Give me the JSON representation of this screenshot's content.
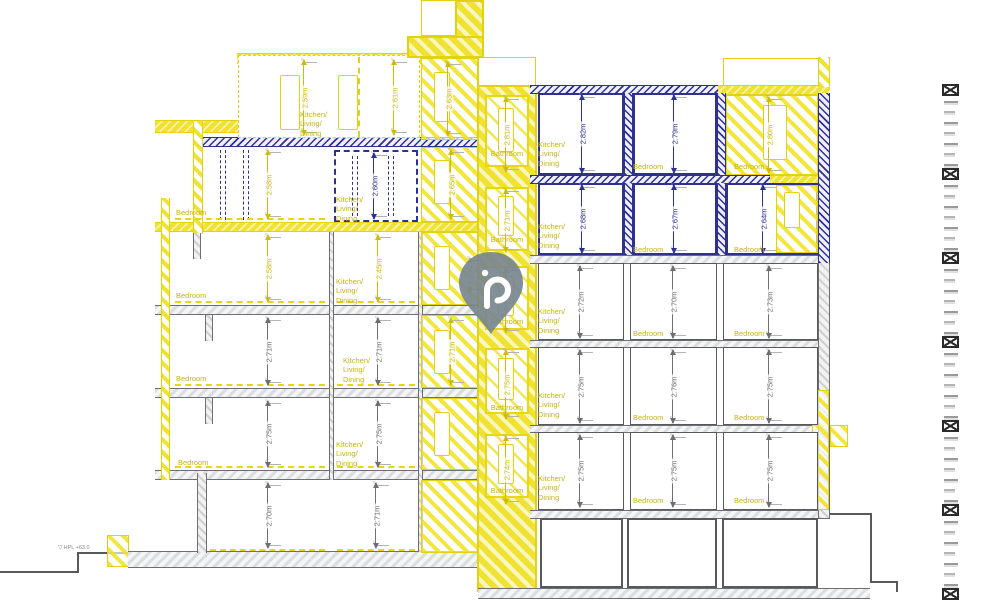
{
  "drawing": {
    "type": "building-section-elevation"
  },
  "colors": {
    "accent_yellow": "#f2e431",
    "label_yellow": "#c6b40f",
    "navy": "#2e3192",
    "wall_gray": "#58595b",
    "pin_gray": "#76848f"
  },
  "left_wing": {
    "floors": [
      {
        "level": "attic",
        "rooms": [
          {
            "label": "Kitchen/\nLiving/\nDining",
            "dim": "2.59m"
          },
          {
            "dim": "2.61m"
          },
          {
            "dim": "2.63m"
          }
        ]
      },
      {
        "level": "4",
        "rooms": [
          {
            "label": "Bedroom",
            "dim": "2.58m"
          },
          {
            "label": "Kitchen/\nLiving/\nDining",
            "dim": "2.60m"
          },
          {
            "dim": "2.65m"
          }
        ]
      },
      {
        "level": "3",
        "rooms": [
          {
            "label": "Bedroom",
            "dim": "2.58m"
          },
          {
            "label": "Kitchen/\nLiving/\nDining",
            "dim": "2.45m"
          }
        ]
      },
      {
        "level": "2",
        "rooms": [
          {
            "label": "Bedroom",
            "dim": "2.71m"
          },
          {
            "label": "Kitchen/\nLiving/\nDining",
            "dim": "2.71m"
          },
          {
            "dim": "2.71m"
          }
        ]
      },
      {
        "level": "1",
        "rooms": [
          {
            "label": "Bedroom",
            "dim": "2.75m"
          },
          {
            "label": "Kitchen/\nLiving/\nDining",
            "dim": "2.75m"
          }
        ]
      },
      {
        "level": "ground",
        "rooms": [
          {
            "dim": "2.70m"
          },
          {
            "dim": "2.71m"
          }
        ]
      }
    ]
  },
  "core": {
    "bathrooms": [
      {
        "label": "Bathroom",
        "dim": "2.81m"
      },
      {
        "label": "Bathroom",
        "dim": "2.71m"
      },
      {
        "label": "Bathroom",
        "dim": "2.75m"
      },
      {
        "label": "Bathroom",
        "dim": "2.75m"
      },
      {
        "label": "Bathroom",
        "dim": "2.74m"
      }
    ],
    "landing_dim": "2.29m"
  },
  "right_wing": {
    "floors": [
      {
        "rooms": [
          {
            "label": "Kitchen/\nLiving/\nDining",
            "dim": "2.82m"
          },
          {
            "label": "Bedroom",
            "dim": "2.79m"
          },
          {
            "label": "Bedroom",
            "dim": "2.80m"
          }
        ]
      },
      {
        "rooms": [
          {
            "label": "Kitchen/\nLiving/\nDining",
            "dim": "2.68m"
          },
          {
            "label": "Bedroom",
            "dim": "2.67m"
          },
          {
            "label": "Bedroom",
            "dim": "2.64m"
          }
        ]
      },
      {
        "rooms": [
          {
            "label": "Kitchen/\nLiving/\nDining",
            "dim": "2.72m"
          },
          {
            "label": "Bedroom",
            "dim": "2.70m"
          },
          {
            "label": "Bedroom",
            "dim": "2.73m"
          }
        ]
      },
      {
        "rooms": [
          {
            "label": "Kitchen/\nLiving/\nDining",
            "dim": "2.75m"
          },
          {
            "label": "Bedroom",
            "dim": "2.76m"
          },
          {
            "label": "Bedroom",
            "dim": "2.75m"
          }
        ]
      },
      {
        "rooms": [
          {
            "label": "Kitchen/\nLiving/\nDining",
            "dim": "2.75m"
          },
          {
            "label": "Bedroom",
            "dim": "2.75m"
          },
          {
            "label": "Bedroom",
            "dim": "2.75m"
          }
        ]
      }
    ]
  },
  "annotations": {
    "datum_label": "HPL +63.0"
  },
  "map_pin": {
    "icon": "hook-icon"
  },
  "scale_strip": {
    "marker_count": 7,
    "first_marker_y": 90,
    "marker_spacing": 84,
    "ticks_per_gap": 7
  }
}
